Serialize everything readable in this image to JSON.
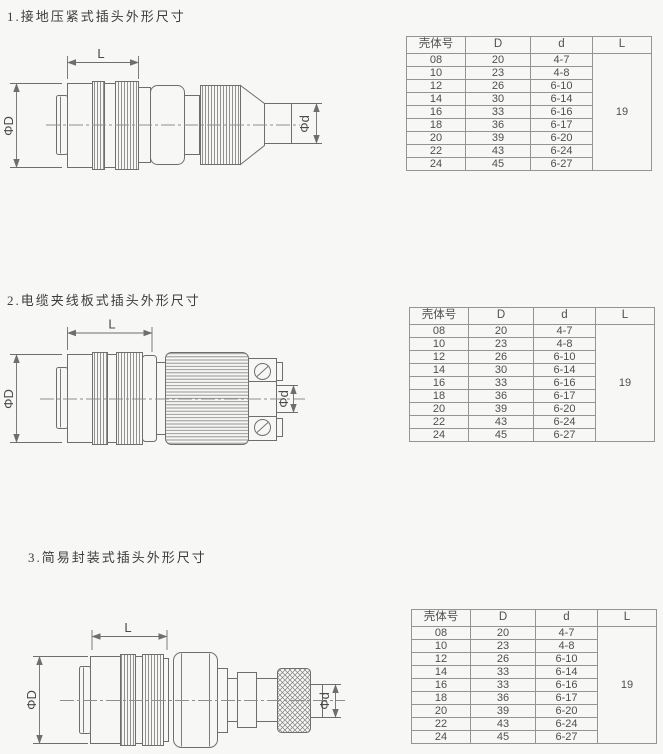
{
  "page": {
    "background": "#f7f7f5",
    "line_color": "#6e6e6e",
    "text_color": "#4a4a4a"
  },
  "sections": [
    {
      "title": "1.接地压紧式插头外形尺寸",
      "drawing": {
        "labels": {
          "length": "L",
          "outer_dia": "ΦD",
          "cable_dia": "Φd"
        }
      },
      "table": {
        "headers": [
          "壳体号",
          "D",
          "d",
          "L"
        ],
        "rows": [
          [
            "08",
            "20",
            "4-7"
          ],
          [
            "10",
            "23",
            "4-8"
          ],
          [
            "12",
            "26",
            "6-10"
          ],
          [
            "14",
            "30",
            "6-14"
          ],
          [
            "16",
            "33",
            "6-16"
          ],
          [
            "18",
            "36",
            "6-17"
          ],
          [
            "20",
            "39",
            "6-20"
          ],
          [
            "22",
            "43",
            "6-24"
          ],
          [
            "24",
            "45",
            "6-27"
          ]
        ],
        "shared_l": "19"
      }
    },
    {
      "title": "2.电缆夹线板式插头外形尺寸",
      "drawing": {
        "labels": {
          "length": "L",
          "outer_dia": "ΦD",
          "cable_dia": "Φd"
        }
      },
      "table": {
        "headers": [
          "壳体号",
          "D",
          "d",
          "L"
        ],
        "rows": [
          [
            "08",
            "20",
            "4-7"
          ],
          [
            "10",
            "23",
            "4-8"
          ],
          [
            "12",
            "26",
            "6-10"
          ],
          [
            "14",
            "30",
            "6-14"
          ],
          [
            "16",
            "33",
            "6-16"
          ],
          [
            "18",
            "36",
            "6-17"
          ],
          [
            "20",
            "39",
            "6-20"
          ],
          [
            "22",
            "43",
            "6-24"
          ],
          [
            "24",
            "45",
            "6-27"
          ]
        ],
        "shared_l": "19"
      }
    },
    {
      "title": "3.简易封装式插头外形尺寸",
      "drawing": {
        "labels": {
          "length": "L",
          "outer_dia": "ΦD",
          "cable_dia": "Φd"
        }
      },
      "table": {
        "headers": [
          "壳体号",
          "D",
          "d",
          "L"
        ],
        "rows": [
          [
            "08",
            "20",
            "4-7"
          ],
          [
            "10",
            "23",
            "4-8"
          ],
          [
            "12",
            "26",
            "6-10"
          ],
          [
            "14",
            "33",
            "6-14"
          ],
          [
            "16",
            "33",
            "6-16"
          ],
          [
            "18",
            "36",
            "6-17"
          ],
          [
            "20",
            "39",
            "6-20"
          ],
          [
            "22",
            "43",
            "6-24"
          ],
          [
            "24",
            "45",
            "6-27"
          ]
        ],
        "shared_l": "19"
      }
    }
  ]
}
